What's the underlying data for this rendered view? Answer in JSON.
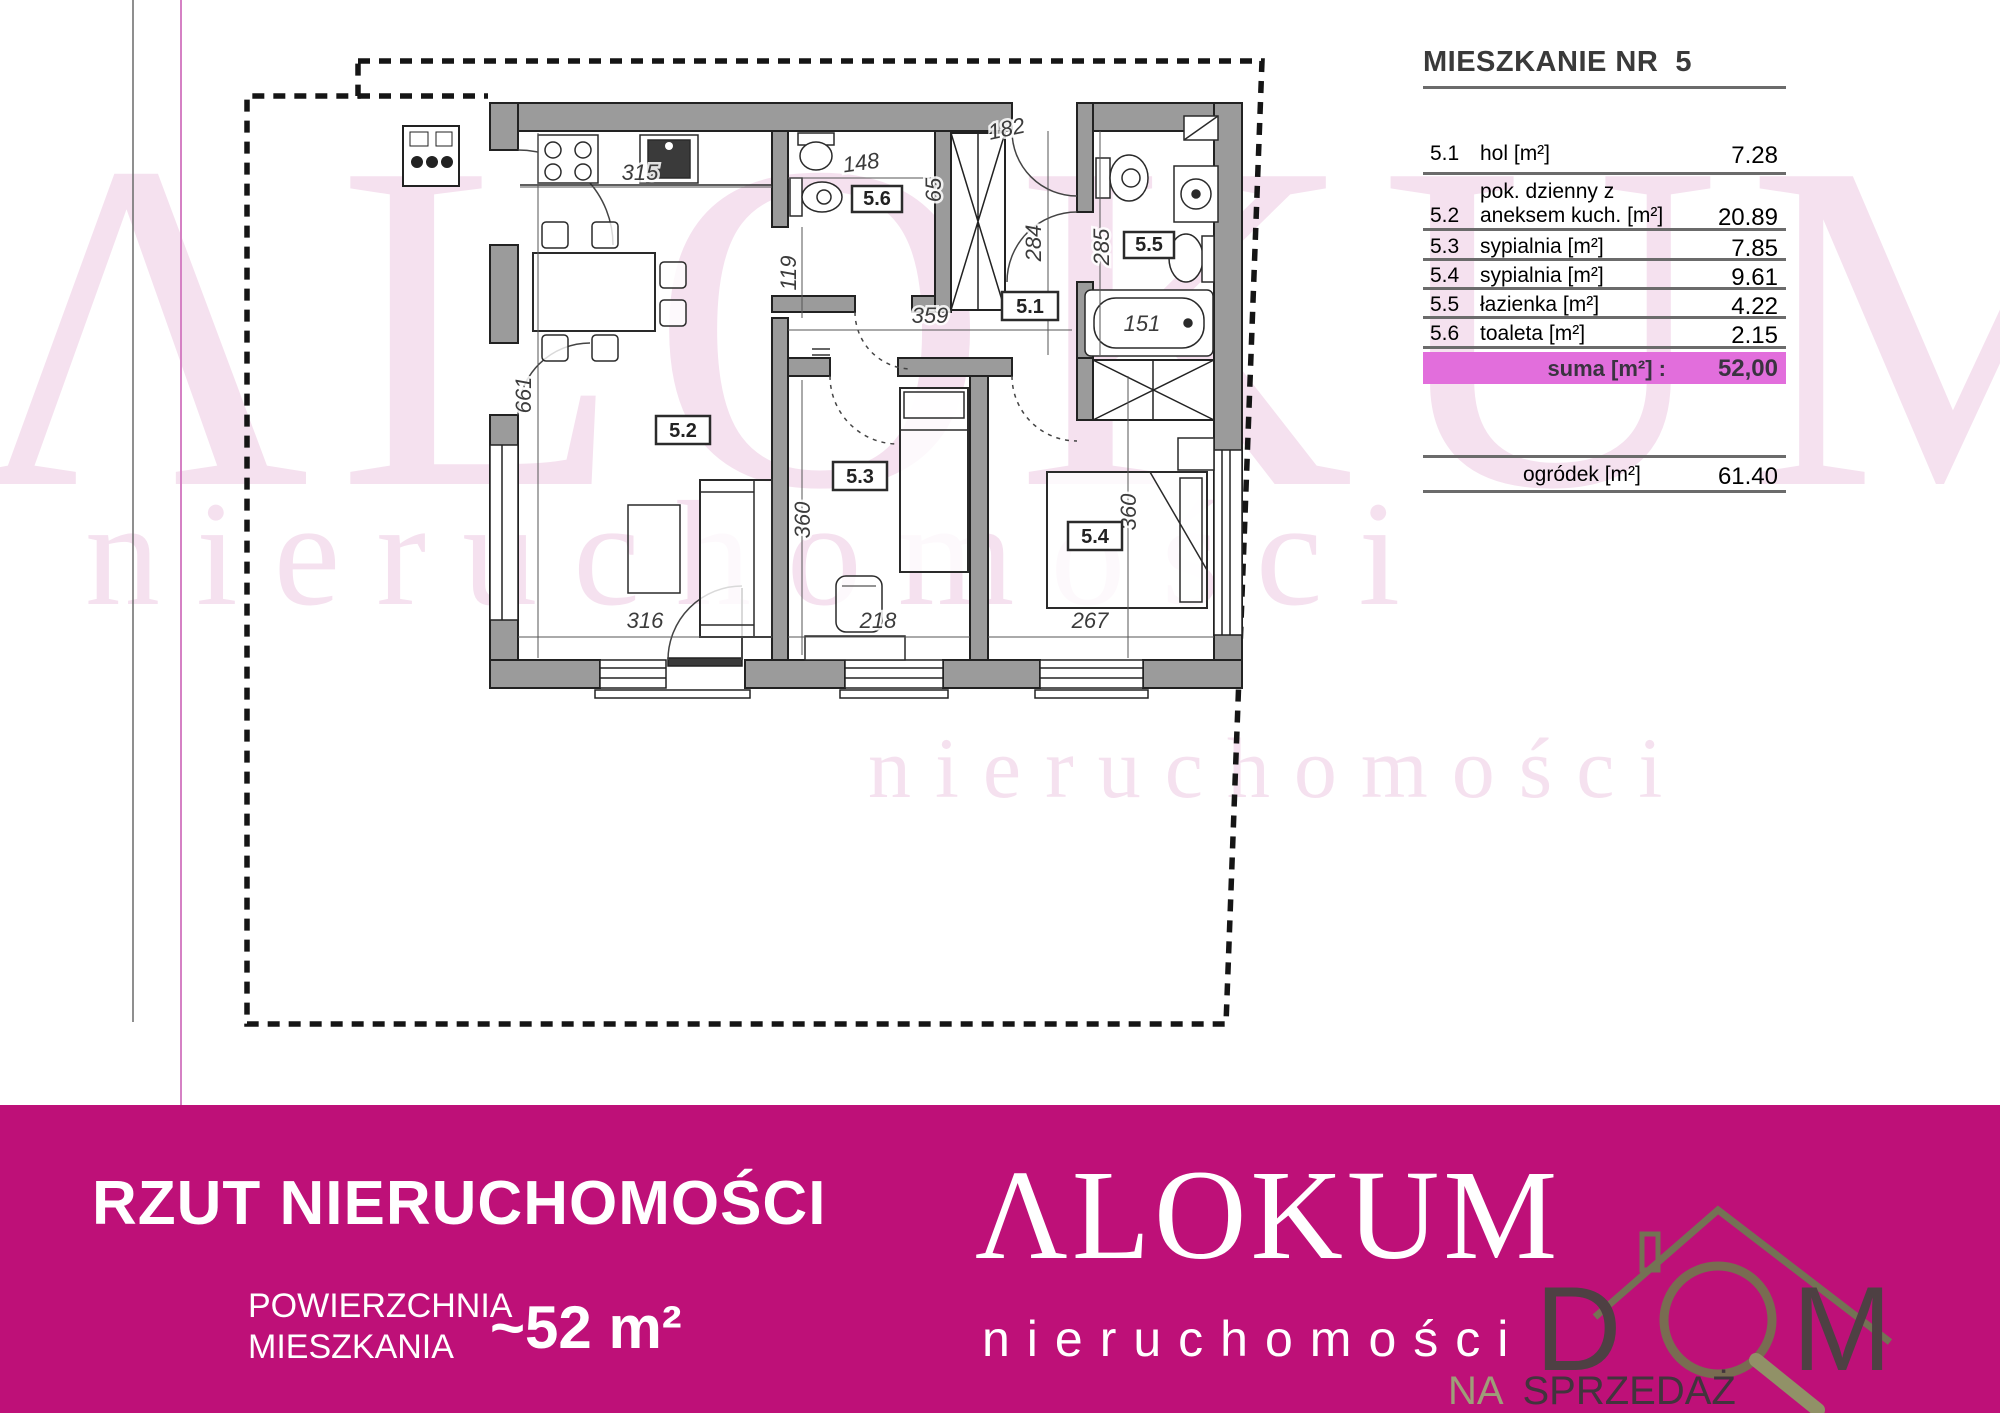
{
  "colors": {
    "banner_bg": "#be1078",
    "suma_highlight": "#e26edc",
    "watermark_pink": "#f5e1ef",
    "wall_gray": "#9b9b9b",
    "page_edge_magenta": "#d581c4"
  },
  "watermark": {
    "brand": "ΛLOKUM",
    "sub": "nieruchomości"
  },
  "plan": {
    "rooms": {
      "r51": "5.1",
      "r52": "5.2",
      "r53": "5.3",
      "r54": "5.4",
      "r55": "5.5",
      "r56": "5.6"
    },
    "dims": {
      "d315": "315",
      "d661": "661",
      "d316": "316",
      "d148": "148",
      "d65": "65",
      "d182": "182",
      "d284": "284",
      "d285": "285",
      "d119": "119",
      "d359": "359",
      "d151": "151",
      "d360a": "360",
      "d360b": "360",
      "d218": "218",
      "d267": "267"
    }
  },
  "unit_table": {
    "title": "MIESZKANIE NR  5",
    "rows": [
      {
        "no": "5.1",
        "label": "hol [m²]",
        "value": "7.28"
      },
      {
        "no": "5.2",
        "label": "pok. dzienny z",
        "label2": "aneksem kuch. [m²]",
        "value": "20.89"
      },
      {
        "no": "5.3",
        "label": "sypialnia [m²]",
        "value": "7.85"
      },
      {
        "no": "5.4",
        "label": "sypialnia [m²]",
        "value": "9.61"
      },
      {
        "no": "5.5",
        "label": "łazienka [m²]",
        "value": "4.22"
      },
      {
        "no": "5.6",
        "label": "toaleta [m²]",
        "value": "2.15"
      }
    ],
    "suma_label": "suma [m²] :",
    "suma_value": "52,00",
    "garden_label": "ogródek [m²]",
    "garden_value": "61.40"
  },
  "banner": {
    "title": "RZUT NIERUCHOMOŚCI",
    "area_label_line1": "POWIERZCHNIA",
    "area_label_line2": "MIESZKANIA",
    "area_value": "~52 m²",
    "brand": "ΛLOKUM",
    "brand_sub": "nieruchomości"
  },
  "overlay": {
    "dom_d": "D",
    "dom_m": "M",
    "na": "NA",
    "sprzedaz": "SPRZEDAŻ"
  }
}
